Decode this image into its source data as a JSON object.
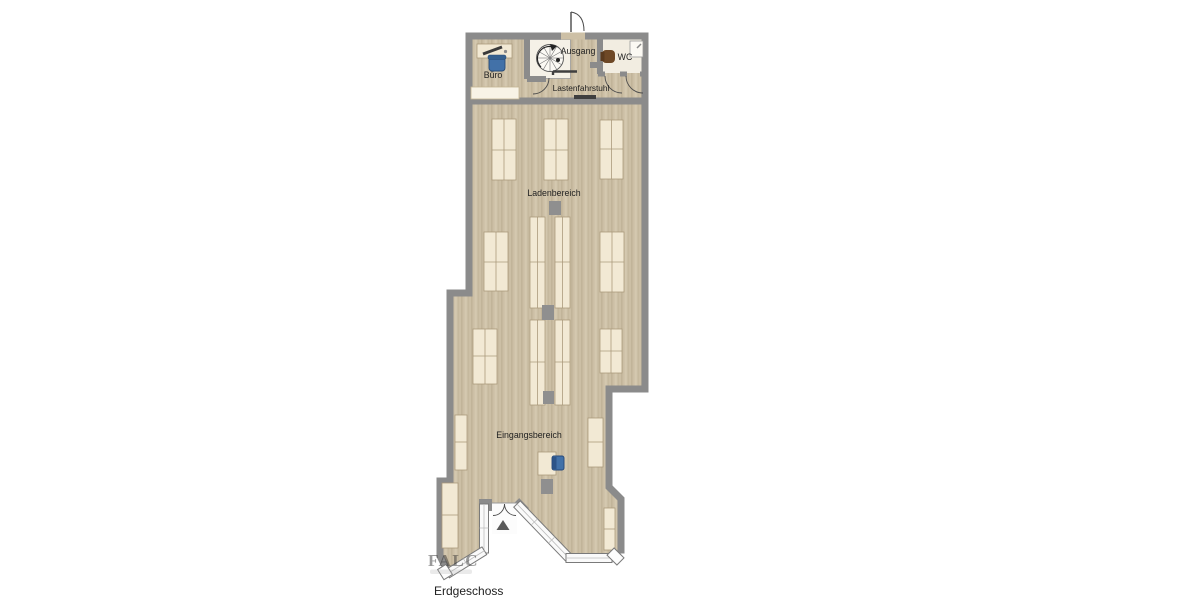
{
  "plan": {
    "floor_label": "Erdgeschoss",
    "watermark": "FALC",
    "labels": {
      "buero": "Büro",
      "ausgang": "Ausgang",
      "wc": "WC",
      "lastenfahrstuhl": "Lastenfahrstuhl",
      "ladenbereich": "Ladenbereich",
      "eingangsbereich": "Eingangsbereich"
    },
    "colors": {
      "wall": "#8b8b8b",
      "floor_base": "#ccbfa5",
      "floor_light": "#f2ede1",
      "furniture": "#f2e9d4",
      "furniture_border": "#ab9a7c",
      "accent_blue": "#4271a8",
      "toilet_brown": "#6e4826",
      "pillar_gray": "#8f8f8f"
    }
  }
}
